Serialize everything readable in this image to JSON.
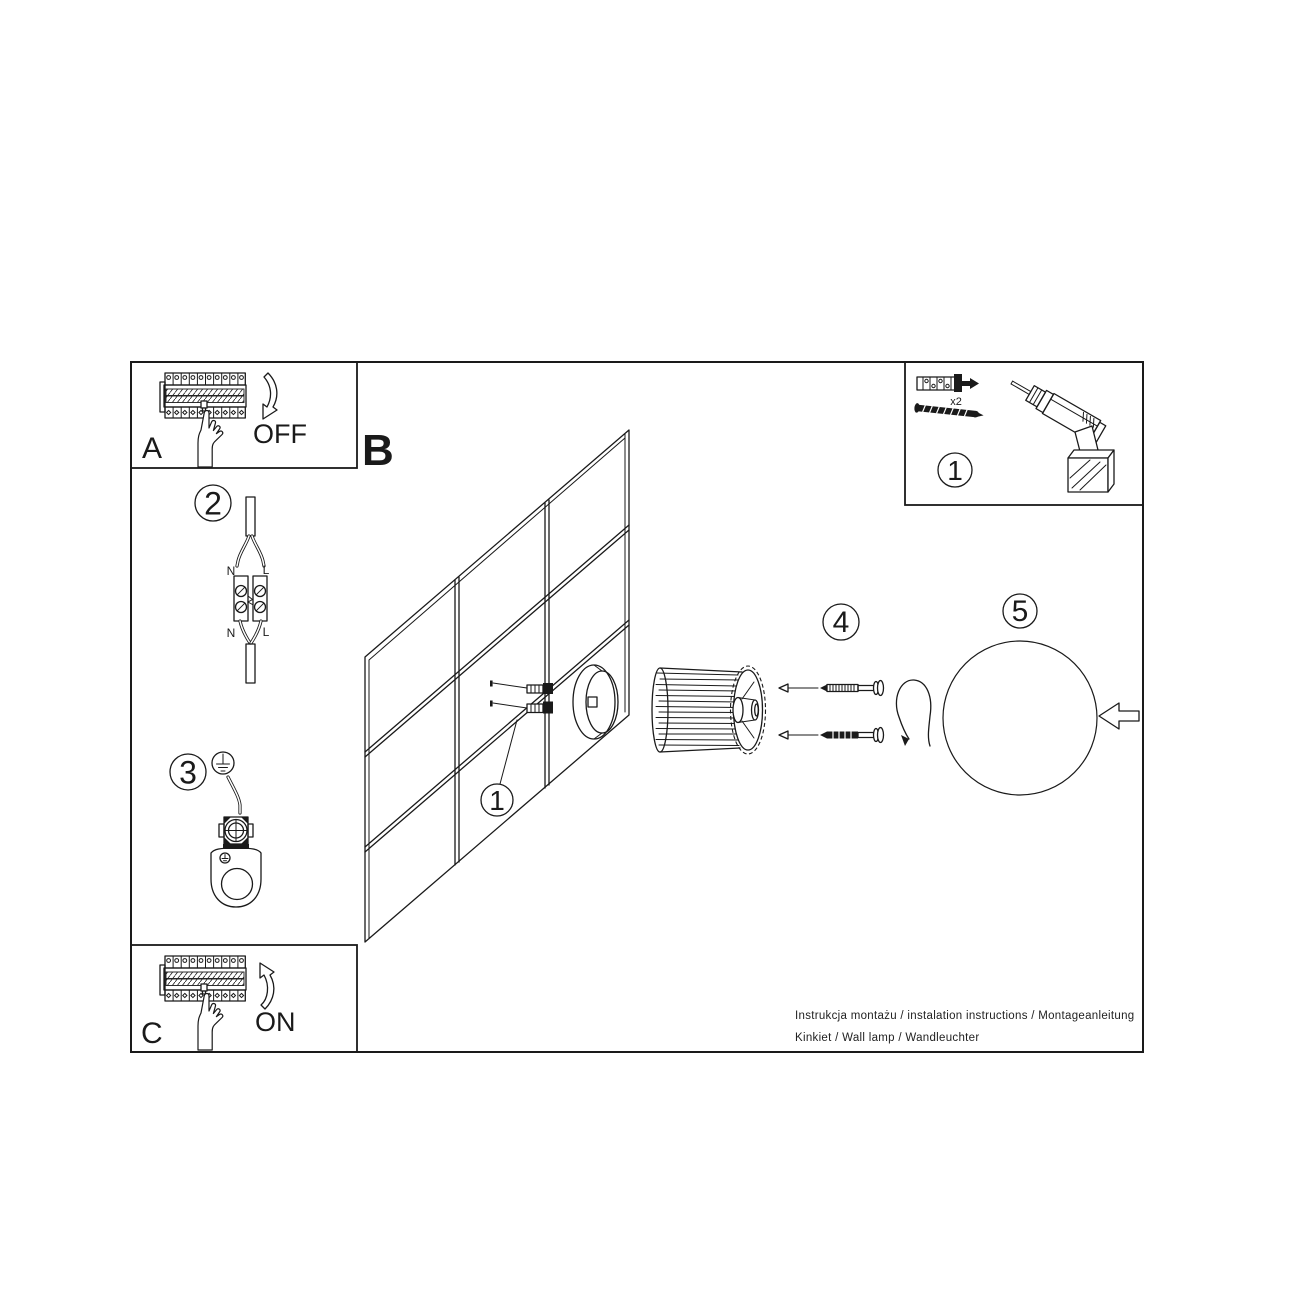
{
  "sheet": {
    "ink_color": "#1a1a1a",
    "background_color": "#ffffff",
    "footer_line1": "Instrukcja montażu / instalation instructions / Montageanleitung",
    "footer_line2": "Kinkiet / Wall lamp / Wandleuchter"
  },
  "power_off_box": {
    "corner_label": "A",
    "action_label": "OFF"
  },
  "power_on_box": {
    "corner_label": "C",
    "action_label": "ON"
  },
  "tools_box": {
    "step_badge": "1",
    "anchor_quantity": "x2"
  },
  "mounting_view": {
    "section_label": "B",
    "anchor_step_badge": "1"
  },
  "wiring_step": {
    "badge": "2",
    "terminal_top_n": "N",
    "terminal_top_l": "L",
    "terminal_bottom_n": "N",
    "terminal_bottom_l": "L"
  },
  "ground_step": {
    "badge": "3"
  },
  "screw_step": {
    "badge": "4"
  },
  "shade_step": {
    "badge": "5"
  }
}
